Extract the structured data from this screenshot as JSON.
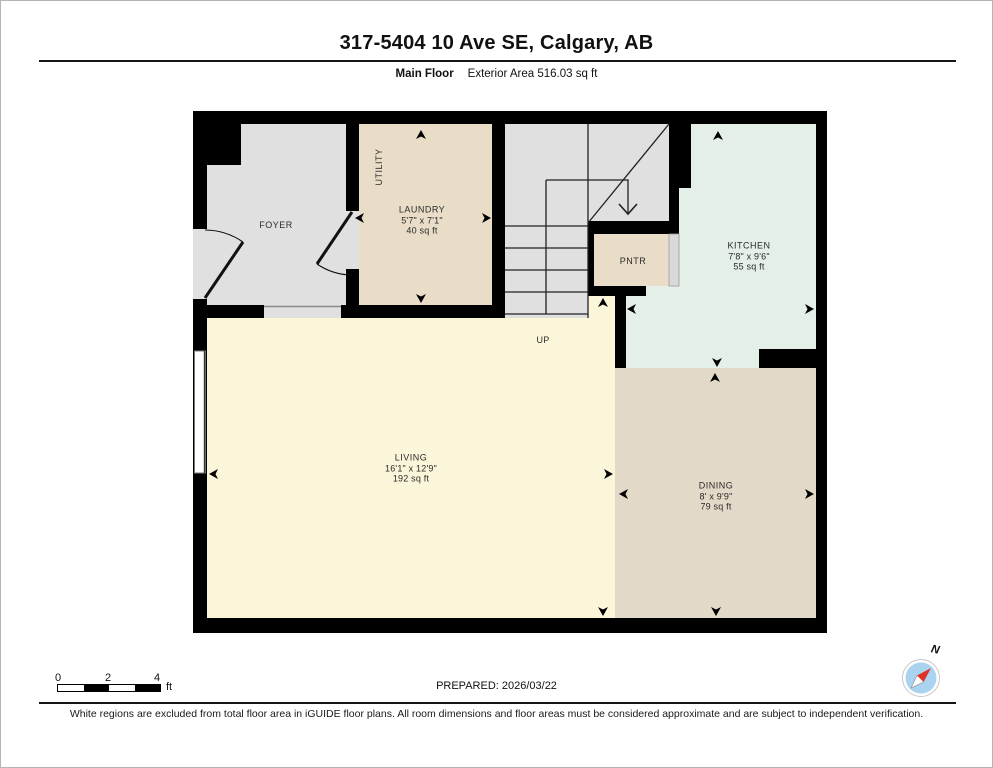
{
  "header": {
    "title": "317-5404 10 Ave SE, Calgary, AB",
    "floor_label": "Main Floor",
    "area_label": "Exterior Area 516.03 sq ft"
  },
  "rooms": {
    "foyer": {
      "name": "FOYER"
    },
    "utility": {
      "name": "UTILITY"
    },
    "laundry": {
      "name": "LAUNDRY",
      "dims": "5'7\" x 7'1\"",
      "area": "40 sq ft"
    },
    "pantry": {
      "name": "PNTR"
    },
    "kitchen": {
      "name": "KITCHEN",
      "dims": "7'8\" x 9'6\"",
      "area": "55 sq ft"
    },
    "living": {
      "name": "LIVING",
      "dims": "16'1\" x 12'9\"",
      "area": "192 sq ft"
    },
    "dining": {
      "name": "DINING",
      "dims": "8' x 9'9\"",
      "area": "79 sq ft"
    },
    "stairs": {
      "direction_label": "UP"
    }
  },
  "footer": {
    "scale": {
      "labels": [
        "0",
        "2",
        "4"
      ],
      "unit": "ft"
    },
    "prepared": "PREPARED: 2026/03/22",
    "compass_label": "N",
    "disclaimer": "White regions are excluded from total floor area in iGUIDE floor plans. All room dimensions and floor areas must be considered approximate and are subject to independent verification."
  },
  "colors": {
    "wall": "#000000",
    "foyer": "#e0e0e0",
    "stairs": "#e0e0e0",
    "laundry": "#e9ddc8",
    "pantry": "#e9ddc8",
    "pantry_door": "#d9d9d9",
    "kitchen": "#e4efe8",
    "living": "#fbf6d9",
    "dining": "#e3d9c9",
    "opening": "#e0e0e0",
    "compass_circle": "#a9d3ee",
    "compass_needle": "#e03127"
  }
}
